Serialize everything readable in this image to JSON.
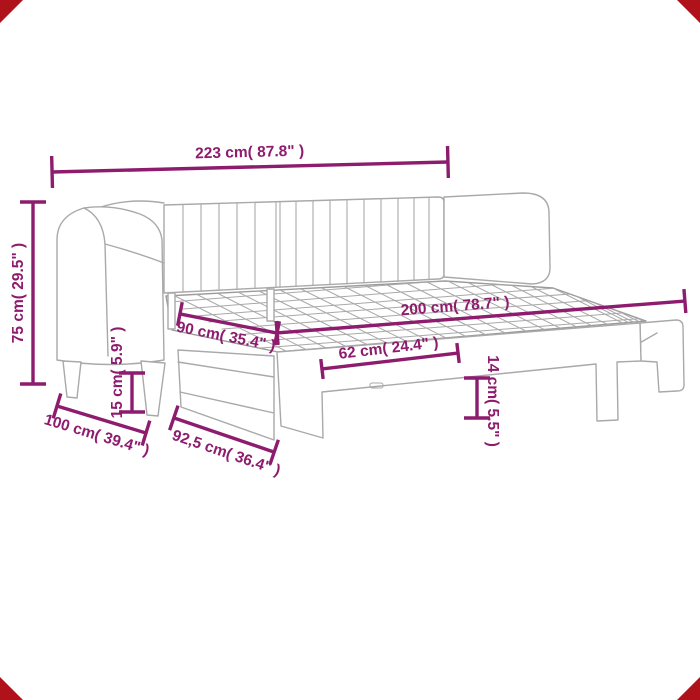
{
  "diagram": {
    "figure_label": "daybed-with-pullout-trundle-dimension-diagram",
    "accent_color": "#8E1C6E",
    "furniture_line_color": "#A9A9A9",
    "corner_marker_color": "#B0121B",
    "dimensions": {
      "total_width": "223 cm( 87.8\" )",
      "total_height": "75 cm( 29.5\" )",
      "bed_length": "200 cm( 78.7\" )",
      "bed_width": "90 cm( 35.4\" )",
      "leg_opening_width": "62 cm( 24.4\" )",
      "left_clearance": "15 cm( 5.9\" )",
      "right_clearance": "14 cm( 5.5\" )",
      "total_depth": "100 cm( 39.4\" )",
      "trundle_depth": "92,5 cm( 36.4\" )"
    }
  }
}
